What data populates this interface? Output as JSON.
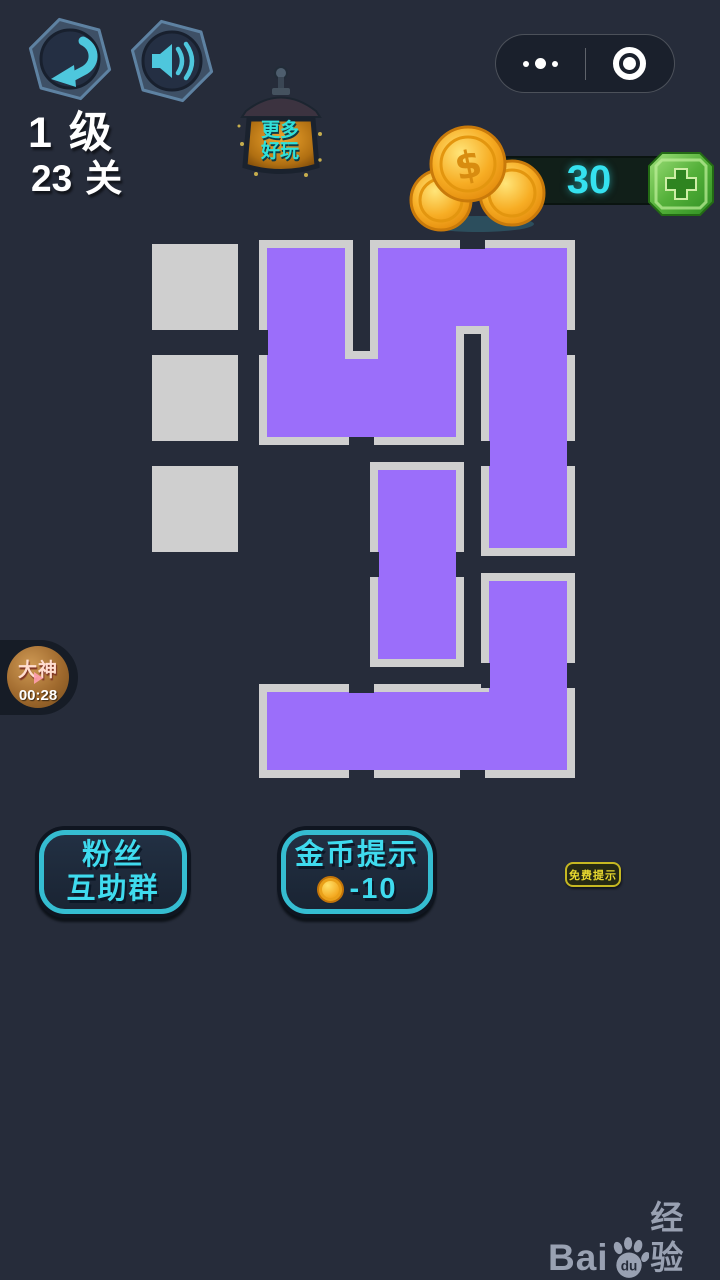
{
  "colors": {
    "background": "#262c3a",
    "purple_piece": "#9b6efa",
    "block_gray": "#cfcfcf",
    "teal_icon": "#4ec7dd",
    "cyan_text": "#3fdbee",
    "coin_value_cyan": "#35e1ef",
    "button_border_teal": "#35bdd1",
    "yellow": "#e6d52f"
  },
  "header": {
    "level": {
      "value": "1",
      "unit": "级"
    },
    "stage": {
      "value": "23",
      "unit": "关"
    },
    "lantern": {
      "line1": "更多",
      "line2": "好玩"
    }
  },
  "currency": {
    "coins": "30"
  },
  "timer_badge": {
    "label": "大神",
    "time": "00:28"
  },
  "puzzle": {
    "grid": {
      "origin_x": 152,
      "origin_y": 244,
      "cell": 86,
      "pitch": 111,
      "cols": 4,
      "rows": 5
    },
    "gray_blocks": [
      [
        0,
        0
      ],
      [
        0,
        1
      ],
      [
        0,
        2
      ]
    ],
    "pieces": [
      {
        "name": "piece-snake",
        "path": "M263,244 L349,244 L349,355 L374,355 L374,244 L571,244 L571,552 L485,552 L485,330 L460,330 L460,441 L263,441 Z"
      },
      {
        "name": "piece-domino",
        "path": "M374,466 L460,466 L460,663 L374,663 Z"
      },
      {
        "name": "piece-hook",
        "path": "M263,688 L485,688 L485,577 L571,577 L571,774 L263,774 Z"
      }
    ],
    "outline_notches": [
      [
        460,
        240,
        25,
        9
      ],
      [
        567,
        330,
        9,
        25
      ],
      [
        567,
        441,
        9,
        25
      ],
      [
        481,
        441,
        9,
        25
      ],
      [
        349,
        437,
        25,
        9
      ],
      [
        259,
        330,
        9,
        25
      ],
      [
        370,
        552,
        9,
        25
      ],
      [
        456,
        552,
        9,
        25
      ],
      [
        349,
        684,
        25,
        9
      ],
      [
        481,
        663,
        9,
        25
      ],
      [
        567,
        663,
        9,
        25
      ],
      [
        349,
        770,
        25,
        9
      ],
      [
        460,
        770,
        25,
        9
      ]
    ]
  },
  "buttons": {
    "fans_group": {
      "line1": "粉丝",
      "line2": "互助群"
    },
    "coin_hint": {
      "label": "金币提示",
      "cost": "-10"
    },
    "free_hint": {
      "label": "免费提示"
    }
  },
  "watermark": {
    "brand_latin": "Bai",
    "brand_du": "du",
    "brand_cn": "经验",
    "url": "jingyan.baidu.com"
  }
}
